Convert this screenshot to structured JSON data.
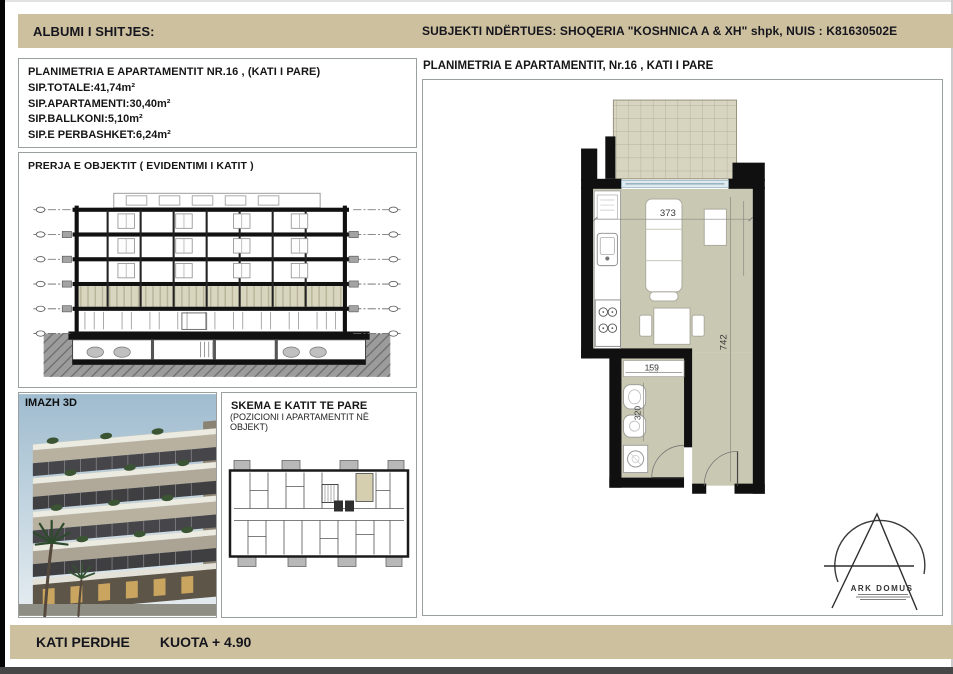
{
  "header": {
    "left": "ALBUMI I SHITJES:",
    "right": "SUBJEKTI NDËRTUES:  SHOQERIA \"KOSHNICA A & XH\" shpk, NUIS : K81630502E"
  },
  "info_panel": {
    "title": "PLANIMETRIA E APARTAMENTIT NR.16 , (KATI I PARE)",
    "lines": [
      "SIP.TOTALE:41,74m²",
      "SIP.APARTAMENTI:30,40m²",
      "SIP.BALLKONI:5,10m²",
      "SIP.E PERBASHKET:6,24m²"
    ]
  },
  "section_panel": {
    "title": "PRERJA E OBJEKTIT ( EVIDENTIMI I KATIT )"
  },
  "image_panel": {
    "label": "IMAZH 3D"
  },
  "schema_panel": {
    "title": "SKEMA E KATIT TE PARE",
    "subtitle": "(POZICIONI I APARTAMENTIT NË OBJEKT)"
  },
  "plan_panel": {
    "title": "PLANIMETRIA E APARTAMENTIT, Nr.16 , KATI I PARE",
    "dim_width": "373",
    "dim_height": "742",
    "dim_bath_width": "159",
    "dim_bath_height": "320"
  },
  "footer": {
    "left": "KATI PERDHE",
    "right": "KUOTA + 4.90"
  },
  "logo": {
    "name": "ARK DOMUS"
  },
  "colors": {
    "header_band": "#cdc09e",
    "plan_floor": "#c9c8b3",
    "balcony_tile": "#d7d4c0",
    "floor_highlight": "#d9d6c0",
    "schema_highlight": "#d5cfb0",
    "wall": "#101010",
    "glass": "#dfeaf0"
  }
}
